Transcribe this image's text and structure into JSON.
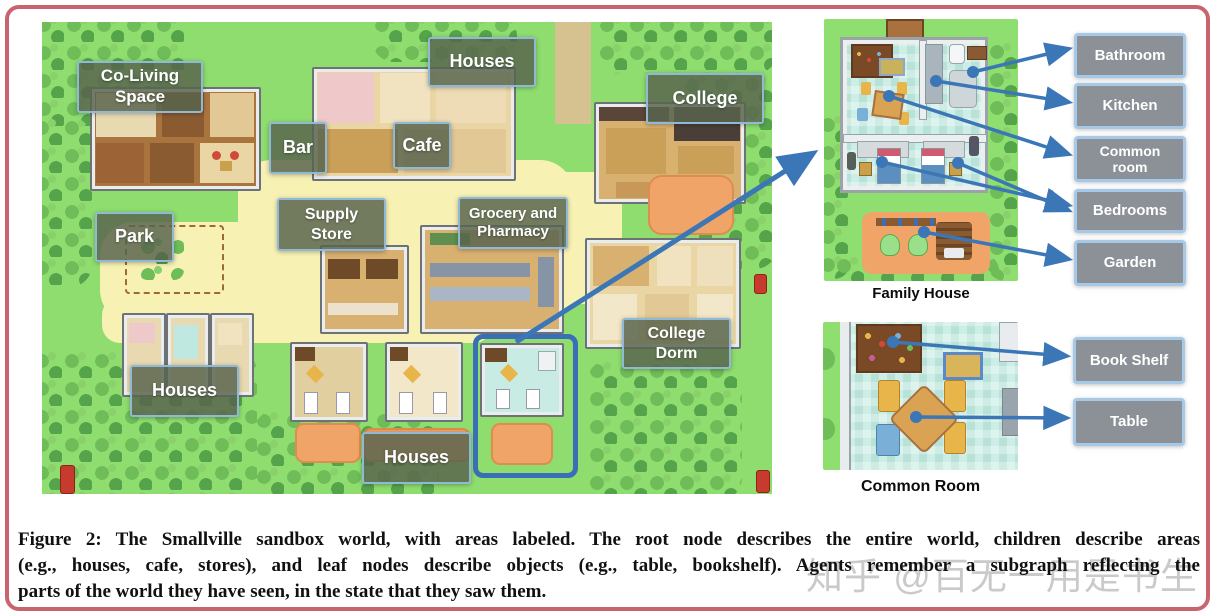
{
  "map": {
    "labels": [
      "Co-Living\nSpace",
      "Houses",
      "Bar",
      "Cafe",
      "College",
      "Supply\nStore",
      "Grocery and\nPharmacy",
      "Park",
      "Houses",
      "College\nDorm",
      "Houses"
    ]
  },
  "family_house": {
    "caption": "Family House",
    "labels": [
      "Bathroom",
      "Kitchen",
      "Common\nroom",
      "Bedrooms",
      "Garden"
    ]
  },
  "common_room": {
    "caption": "Common Room",
    "labels": [
      "Book Shelf",
      "Table"
    ]
  },
  "caption": {
    "lines": [
      "Figure 2: The Smallville sandbox world, with areas labeled. The root node describes the entire world, children describe areas",
      "(e.g., houses, cafe, stores), and leaf nodes describe objects (e.g., table, bookshelf). Agents remember a subgraph reflecting the",
      "parts of the world they have seen, in the state that they saw them."
    ]
  },
  "watermark": "知乎 @百无一用是书生",
  "colors": {
    "arrow": "#3b76b7",
    "map_label_bg": "#5a6850",
    "detail_label_bg": "#8b9196",
    "frame_border": "#c9636e",
    "highlight_box": "#3a6fb5"
  }
}
